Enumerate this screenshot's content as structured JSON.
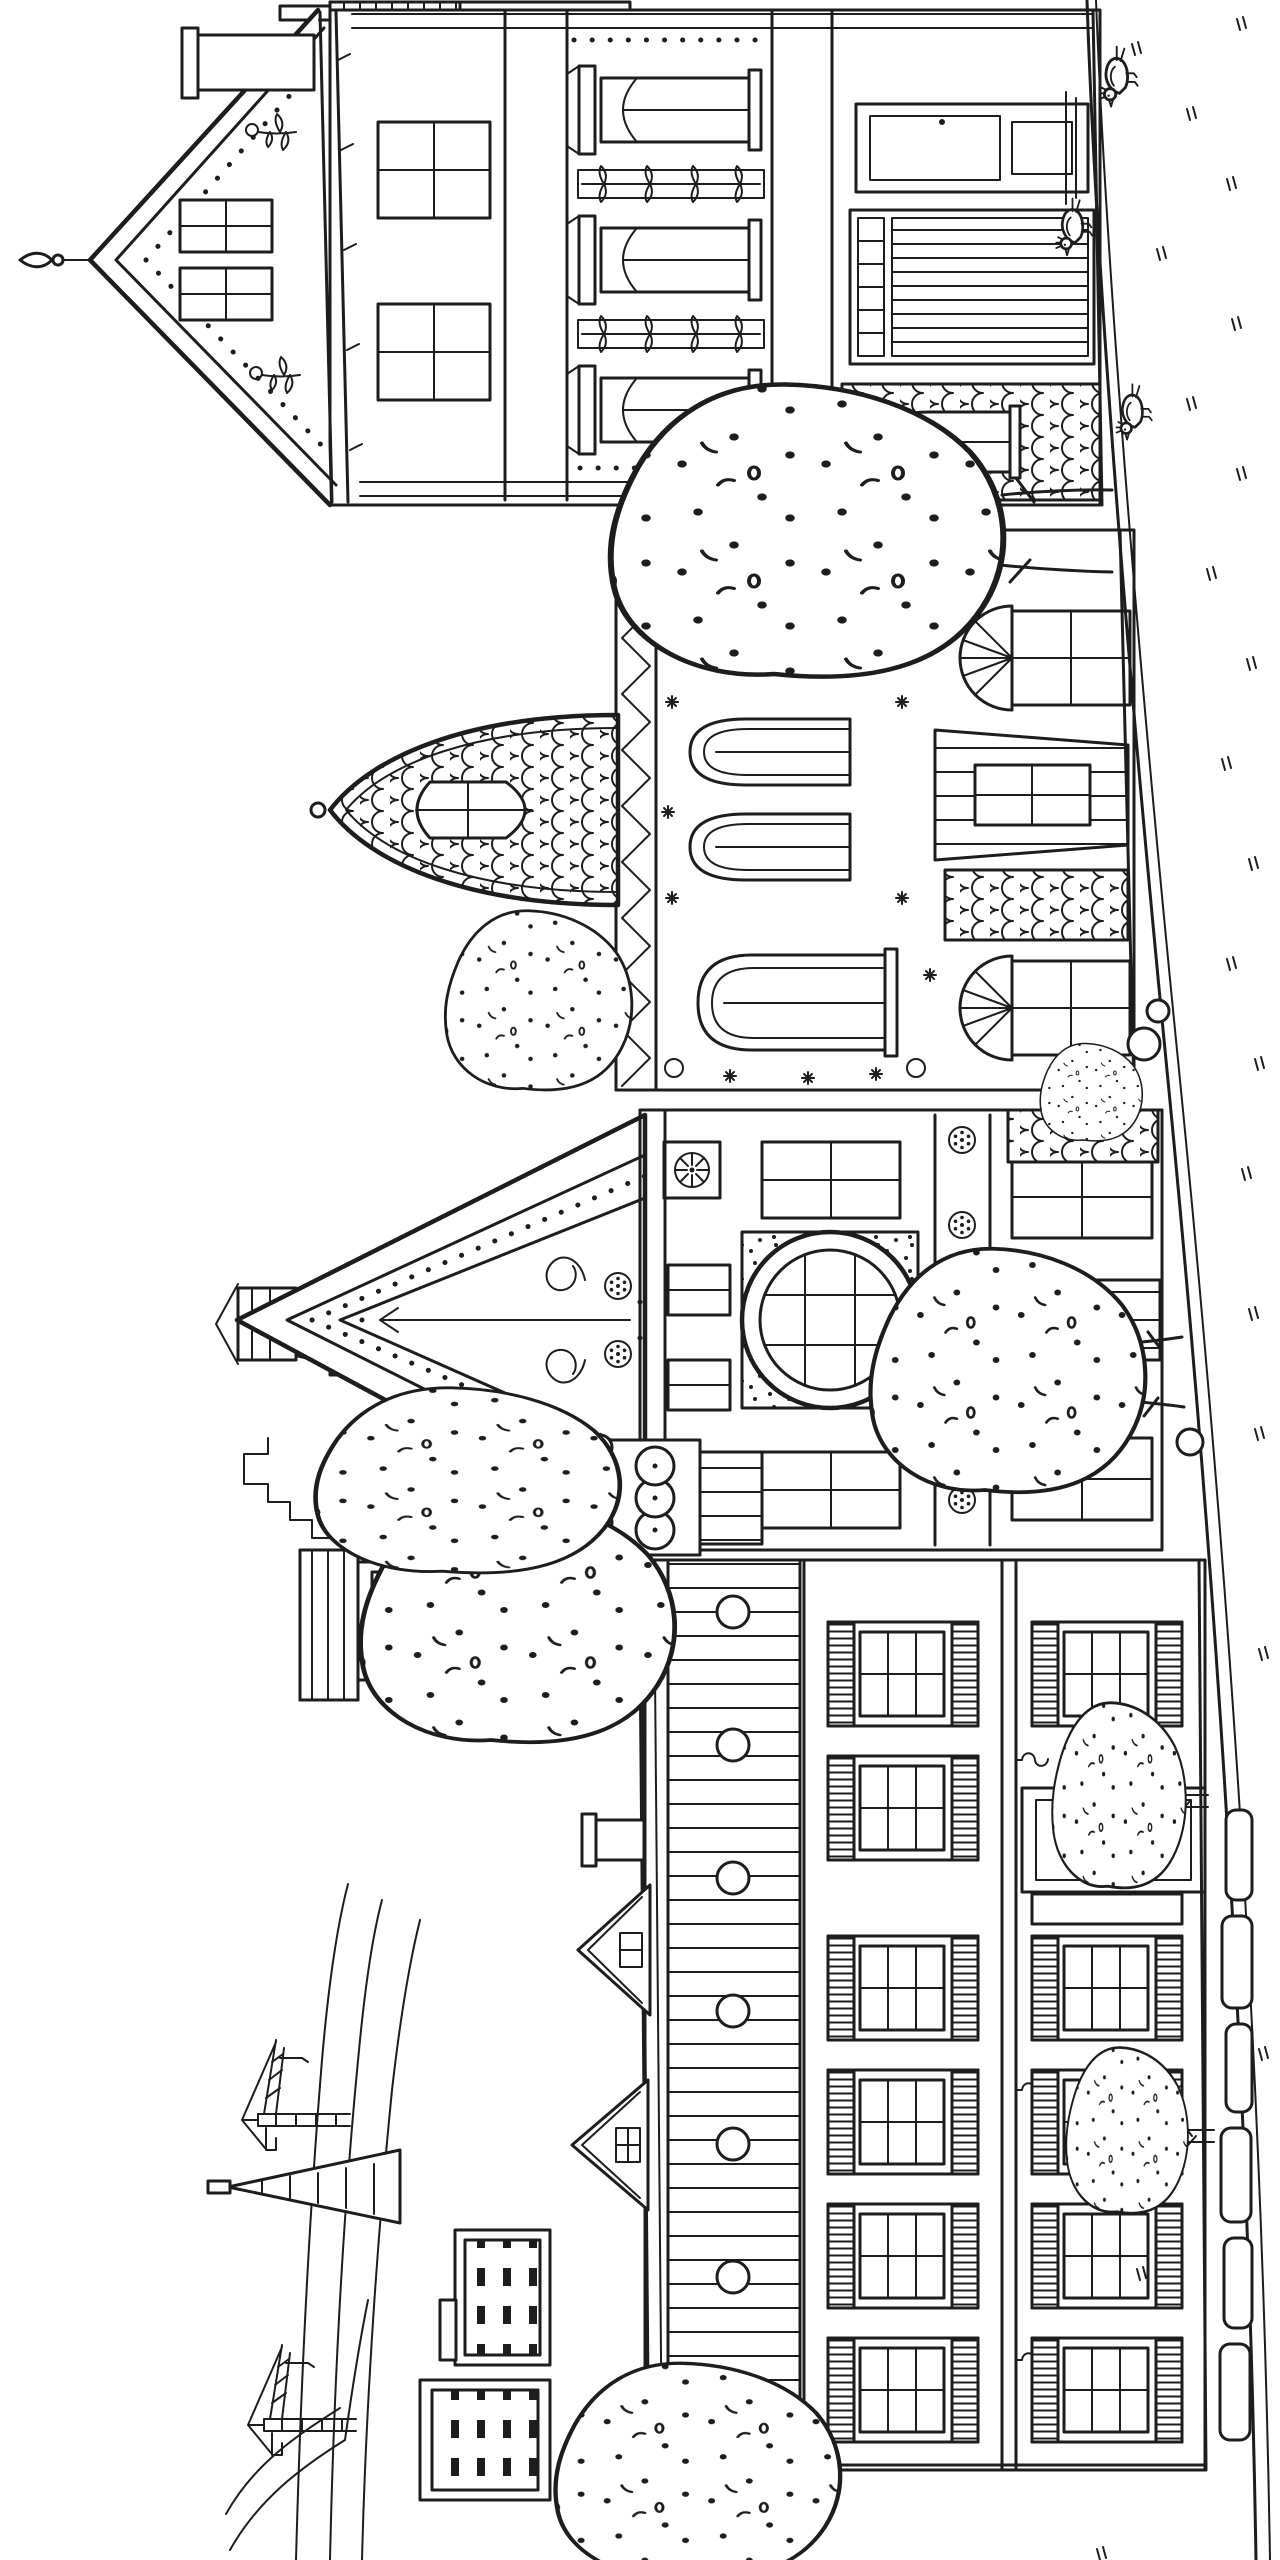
{
  "page": {
    "type": "coloring-book line illustration",
    "subject": "Row of ornate Victorian houses along a street with a distant city skyline",
    "orientation": "landscape artwork rotated 90 degrees on a portrait page",
    "style": "black ink outlines on white paper, uncolored"
  },
  "palette": {
    "ink": "#1d1d1d",
    "paper": "#ffffff"
  },
  "labels": {
    "illustration": "Victorian street coloring page, rotated sideways",
    "background_hills": "Distant hills and winding roads",
    "construction_cranes": "Construction cranes on the horizon",
    "pyramid_tower": "Pyramid-shaped skyscraper",
    "background_buildings": "Distant skyscrapers and blocks with tiny windows",
    "water_tower": "Rooftop water tower on legs",
    "house_shutters": "Long building with louvered shutter windows, porthole frieze, iron hooks and spiral-ornament door",
    "house_rose_window": "Tall house with ornate swirl gable, round rose window, medallion band and checkered cone turret",
    "cone_turret": "Checkered cone spire with scalloped collar and dotted circles",
    "house_scalloped_turret": "House with fish-scale ogee turret, shield window, star-sprinkled walls, zigzag band, arched and fan windows",
    "house_front_gable": "Grand house with tall front gable, finial mast, floral sprigs, garland bands, pediment windows, paneled bay and porch",
    "trees": "Speckled leafy street trees",
    "bushes": "Speckled bushes and small trees by the sidewalk",
    "street": "Empty street and sidewalk with scattered tick marks",
    "paving_stones": "Paving stone slabs along the building",
    "rocks": "Small rocks by the curb",
    "pigeons": "Pigeons walking on the street"
  },
  "inventory": {
    "houses": 4,
    "trees": 6,
    "bushes": 3,
    "pigeons": 3,
    "construction_cranes": 2,
    "water_towers": 1,
    "pyramid_towers": 1,
    "paving_stones": 6,
    "porthole_circles": 7,
    "rosette_squares": 2,
    "fan_windows": 2
  }
}
